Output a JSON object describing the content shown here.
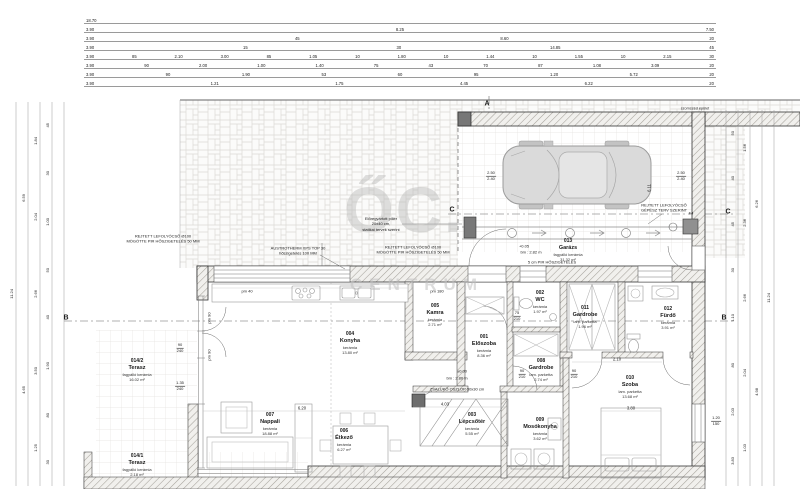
{
  "watermark": {
    "monogram": "ŐC.",
    "word": "CENTRUM"
  },
  "rooms": [
    {
      "number": "001",
      "name": "Előszoba",
      "finish": "kerámia",
      "area": "8.36 m²"
    },
    {
      "number": "002",
      "name": "WC",
      "finish": "kerámia",
      "area": "1.97 m²"
    },
    {
      "number": "003",
      "name": "Lépcsőtér",
      "finish": "kerámia",
      "area": "5.55 m²"
    },
    {
      "number": "004",
      "name": "Konyha",
      "finish": "kerámia",
      "area": "13.80 m²"
    },
    {
      "number": "005",
      "name": "Kamra",
      "finish": "kerámia",
      "area": "2.71 m²"
    },
    {
      "number": "006",
      "name": "Étkező",
      "finish": "kerámia",
      "area": "6.27 m²"
    },
    {
      "number": "007",
      "name": "Nappali",
      "finish": "kerámia",
      "area": "18.88 m²"
    },
    {
      "number": "008",
      "name": "Gardrobe",
      "finish": "lam. parketta",
      "area": "2.74 m²"
    },
    {
      "number": "009",
      "name": "Mosókonyha",
      "finish": "kerámia",
      "area": "3.62 m²"
    },
    {
      "number": "010",
      "name": "Szoba",
      "finish": "lam. parketta",
      "area": "13.68 m²"
    },
    {
      "number": "011",
      "name": "Gardrobe",
      "finish": "lam. parketta",
      "area": "1.96 m²"
    },
    {
      "number": "012",
      "name": "Fürdő",
      "finish": "kerámia",
      "area": "3.91 m²"
    },
    {
      "number": "013",
      "name": "Garázs",
      "finish": "fagyálló kerámia",
      "area": "31.32 m²"
    },
    {
      "number": "014/1",
      "name": "Terasz",
      "finish": "fagyálló kerámia",
      "area": "2.18 m²"
    },
    {
      "number": "014/2",
      "name": "Terasz",
      "finish": "fagyálló kerámia",
      "area": "16.02 m²"
    }
  ],
  "annotations": {
    "neighbor": "szomszéd épület",
    "hidden_drain_pipe": "REJTETT LEFOLYÓCSŐ Ø100\nMÖGÖTTE PIR HŐSZIGETELÉS 50 MM",
    "xps": "AUSTROTHERM XPS TOP 30\nhőszigetelés 100 MM",
    "hidden_drain_mech": "REJTETT LEFOLYÓCSŐ\nGÉPÉSZ TERV SZERINT",
    "precast_pillar": "Előregyártott pillér\n20x40 cm,\nstatikai tervek szerint",
    "zsaluko_column": "ZSALUKŐ OSZLOP 30x30 cm",
    "pir": "5 cm PIR HŐSZIGETELÉS",
    "pm40": "pm 40",
    "pm180": "pm 180",
    "pm90": "pm 90",
    "grate_label": "F4"
  },
  "levels": {
    "garage_level": "+0.05",
    "garage_clearance": "bm : 2.82 m",
    "hall_level": "±0.00",
    "hall_clearance": "bm : 2.80 m"
  },
  "section_markers": {
    "a": "A",
    "b": "B",
    "c": "C"
  },
  "openings": [
    {
      "w": "90",
      "h": "240"
    },
    {
      "w": "1.35",
      "h": "240"
    },
    {
      "w": "2.50",
      "h": "2.40"
    },
    {
      "w": "2.50",
      "h": "2.40"
    },
    {
      "w": "75",
      "h": "210"
    },
    {
      "w": "90",
      "h": "210"
    },
    {
      "w": "90",
      "h": "210"
    },
    {
      "w": "1.20",
      "h": "150"
    }
  ],
  "inline_dims": {
    "living_width": "6.20",
    "stair_width": "4.03",
    "bed_width": "3.80",
    "bedroom_width": "2.10",
    "garage_depth": "6.11"
  },
  "dimensions": {
    "top_rows": [
      [
        "18.70"
      ],
      [
        "3.90",
        "8.25",
        "7.50"
      ],
      [
        "3.90",
        "45",
        "8.60",
        "20"
      ],
      [
        "3.90",
        "15",
        "30",
        "14.85",
        "45"
      ],
      [
        "3.90",
        "85",
        "2.10",
        "3.00",
        "85",
        "1.05",
        "10",
        "1.80",
        "10",
        "1.44",
        "10",
        "1.55",
        "10",
        "2.15",
        "30"
      ],
      [
        "3.90",
        "90",
        "2.00",
        "1.00",
        "1.40",
        "75",
        "43",
        "70",
        "87",
        "1.08",
        "3.09",
        "20"
      ],
      [
        "3.90",
        "90",
        "1.90",
        "53",
        "60",
        "95",
        "1.20",
        "5.72",
        "20"
      ],
      [
        "3.90",
        "1.21",
        "1.75",
        "4.45",
        "6.22",
        "20"
      ]
    ],
    "left_cols": [
      [
        "11.24"
      ],
      [
        "6.59",
        "4.65"
      ],
      [
        "1.84",
        "2.04",
        "2.66",
        "3.50",
        "1.25"
      ],
      [
        "45",
        "30",
        "1.00",
        "50",
        "40",
        "1.90",
        "80",
        "30"
      ]
    ],
    "right_cols": [
      [
        "50",
        "40",
        "45",
        "30",
        "1.10",
        "80",
        "2.03",
        "3.83"
      ],
      [
        "1.56",
        "2.36",
        "2.66",
        "2.04",
        "1.03"
      ],
      [
        "6.26",
        "4.98"
      ],
      [
        "11.24"
      ]
    ]
  }
}
